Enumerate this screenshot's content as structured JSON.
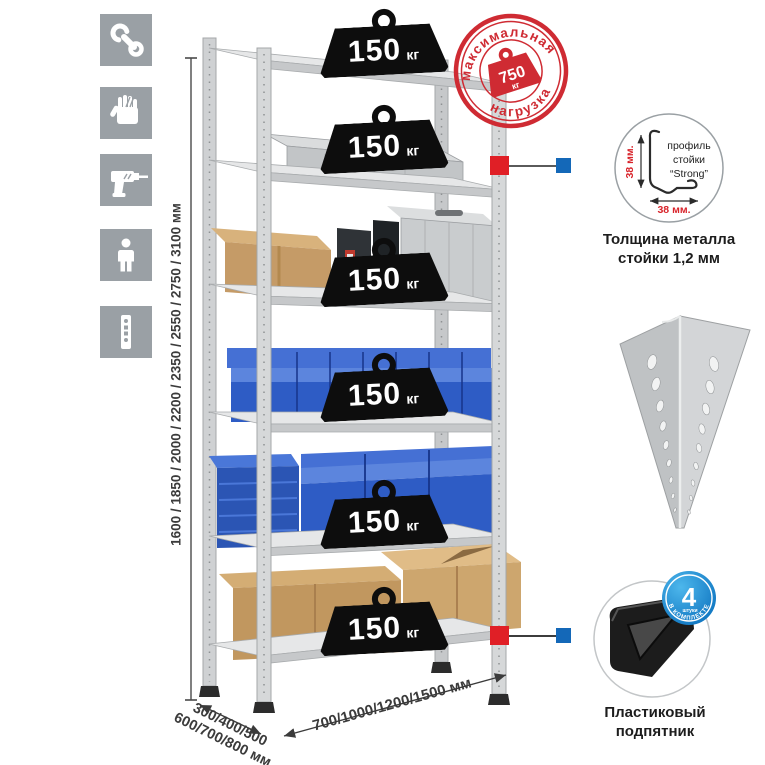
{
  "product": "Металлический стеллаж — схема нагрузок и размеров",
  "sidebar": {
    "tile_color": "#9aa0a5",
    "icons": [
      "wrench",
      "gloves",
      "drill",
      "person",
      "rack-post-profile"
    ]
  },
  "dimensions": {
    "height": "1600 / 1850 / 2000 / 2200 / 2350 / 2550 / 2750 / 3100 мм",
    "depth_line1": "300/400/500",
    "depth_line2": "600/700/800 мм",
    "width": "700/1000/1200/1500 мм"
  },
  "shelf_load": {
    "value": "150",
    "unit": "кг",
    "shelf_count": 6
  },
  "max_load_stamp": {
    "arc_top": "максимальная",
    "arc_bottom": "нагрузка",
    "value": "750",
    "unit": "кг",
    "color": "#cf2b33"
  },
  "profile_detail": {
    "label_line1": "профиль",
    "label_line2": "стойки",
    "label_line3": "“Strong”",
    "dim_left": "38 мм.",
    "dim_bottom": "38 мм.",
    "caption_line1": "Толщина металла",
    "caption_line2": "стойки 1,2 мм"
  },
  "foot_detail": {
    "badge_value": "4",
    "badge_small": "штуки",
    "badge_arc": "в комплекте",
    "caption_line1": "Пластиковый",
    "caption_line2": "подпятник"
  },
  "colors": {
    "accent_red": "#cf2b33",
    "marker_red": "#e01f26",
    "marker_blue": "#1468b8",
    "badge_blue": "#1f8ccc",
    "bin_blue": "#2e5cc5",
    "metal_gray": "#c8cacc"
  }
}
